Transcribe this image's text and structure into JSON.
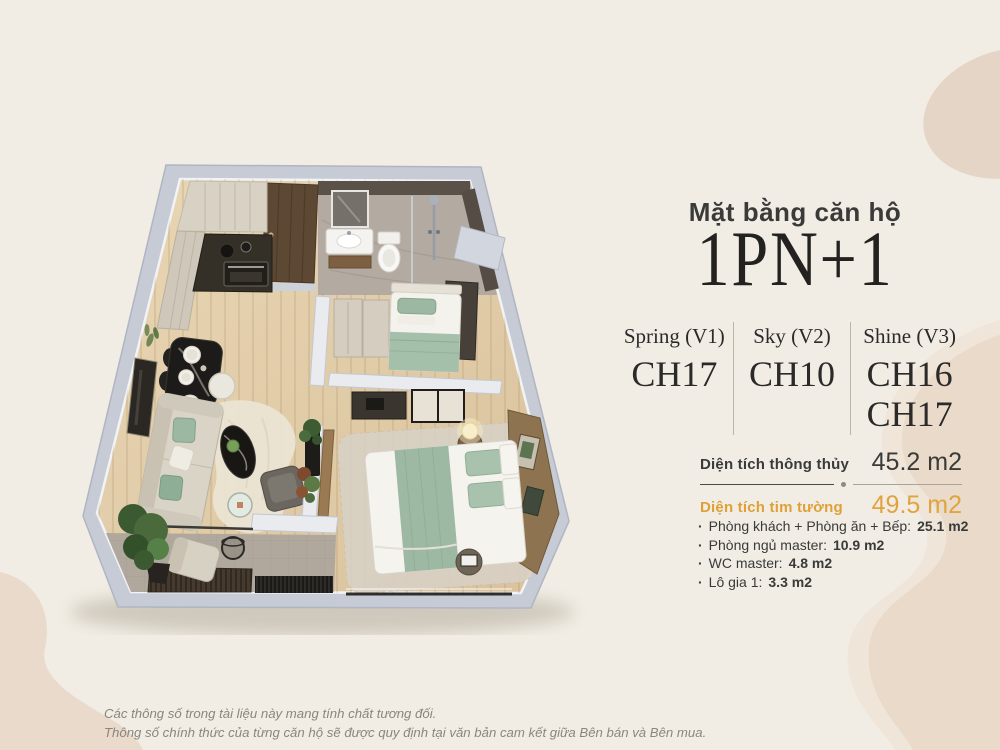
{
  "panel": {
    "subtitle": "Mặt bằng căn hộ",
    "title": "1PN+1",
    "variants": [
      {
        "name": "Spring (V1)",
        "units": [
          "CH17"
        ]
      },
      {
        "name": "Sky (V2)",
        "units": [
          "CH10"
        ]
      },
      {
        "name": "Shine (V3)",
        "units": [
          "CH16",
          "CH17"
        ]
      }
    ],
    "areas": [
      {
        "label": "Diện tích thông thủy",
        "value": "45.2 m2"
      },
      {
        "label": "Diện tích tim tường",
        "value": "49.5 m2"
      }
    ],
    "rooms_bullet": "·",
    "rooms": [
      {
        "label": "Phòng khách + Phòng ăn + Bếp:",
        "value": "25.1 m2"
      },
      {
        "label": "Phòng ngủ master:",
        "value": "10.9 m2"
      },
      {
        "label": "WC master:",
        "value": "4.8 m2"
      },
      {
        "label": "Lô gia 1:",
        "value": "3.3 m2"
      }
    ]
  },
  "footer": {
    "line1": "Các thông số trong tài liệu này mang tính chất tương đối.",
    "line2": "Thông số chính thức của từng căn hộ sẽ được quy định tại văn bản cam kết giữa Bên bán và Bên mua."
  },
  "colors": {
    "background": "#f1ede4",
    "blob_beige": "#e8d9c9",
    "text_dark": "#3a3a38",
    "accent_gold": "#dfa038",
    "wall_gray": "#c6cbd5",
    "wood_floor": "#e3ceaa",
    "textile_green": "#9db9a3"
  }
}
